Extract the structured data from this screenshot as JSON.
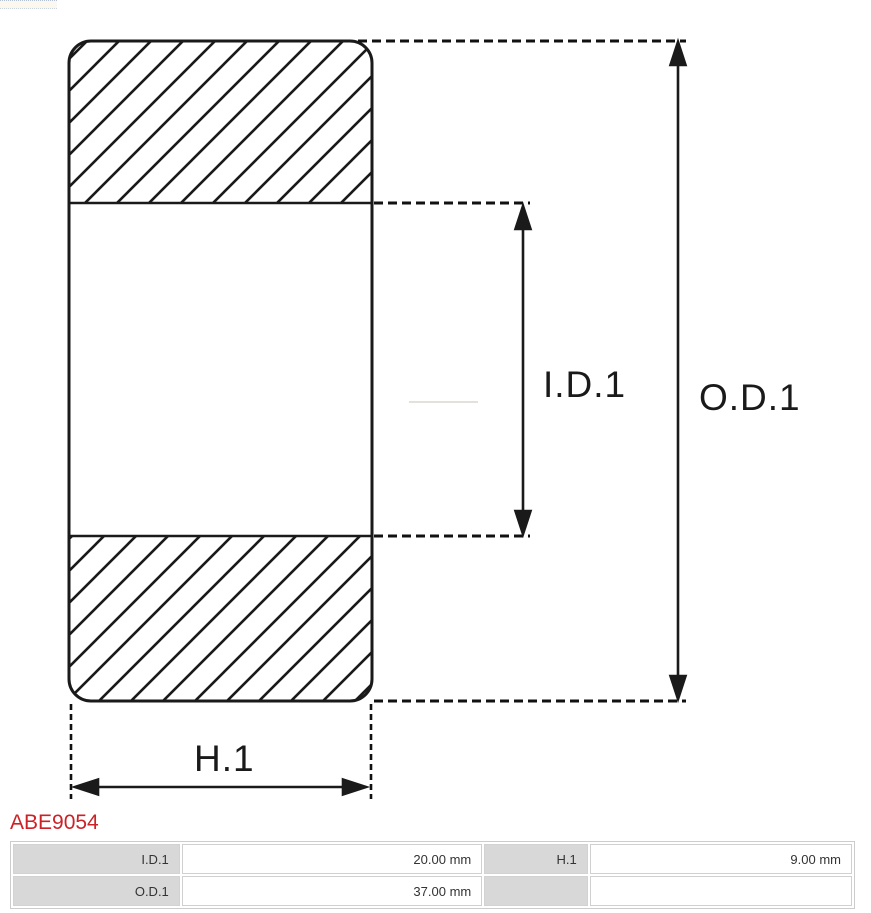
{
  "diagram": {
    "type": "bearing-cross-section",
    "labels": {
      "inner_diameter": "I.D.1",
      "outer_diameter": "O.D.1",
      "width": "H.1"
    }
  },
  "part_number": "ABE9054",
  "colors": {
    "part_number_red": "#cc2127",
    "diagram_line": "#1a1a1a",
    "table_label_bg": "#d8d8d8",
    "table_border": "#cccccc",
    "table_text": "#333333"
  },
  "spec_table": {
    "rows": [
      {
        "cells": [
          {
            "label": "I.D.1",
            "value": "20.00 mm"
          },
          {
            "label": "H.1",
            "value": "9.00 mm"
          }
        ]
      },
      {
        "cells": [
          {
            "label": "O.D.1",
            "value": "37.00 mm"
          },
          {
            "label": "",
            "value": ""
          }
        ]
      }
    ]
  }
}
